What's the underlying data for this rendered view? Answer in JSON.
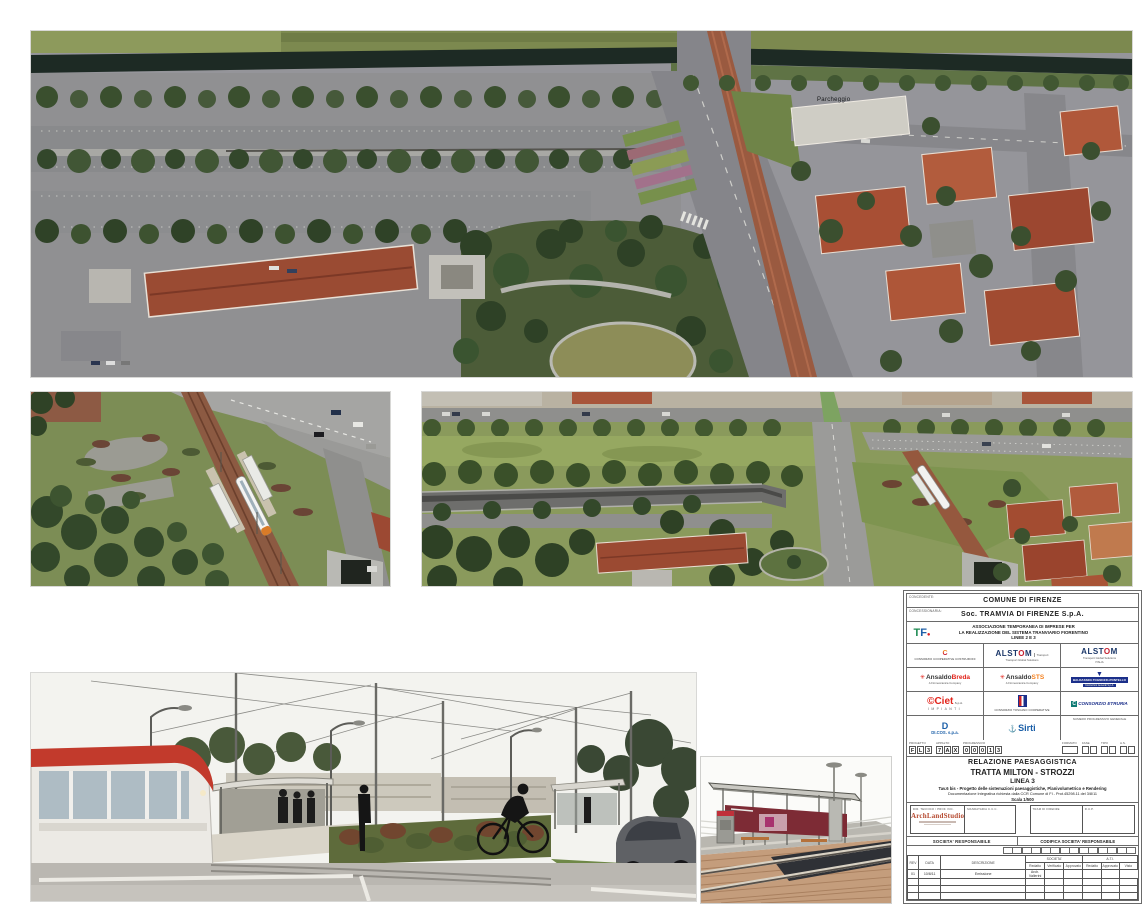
{
  "images": {
    "top_aerial": {
      "label_parcheggio": "Parcheggio"
    }
  },
  "title_block": {
    "concedente_label": "CONCEDENTE:",
    "concedente": "COMUNE DI FIRENZE",
    "concessionaria_label": "CONCESSIONARIA:",
    "concessionaria": "Soc. TRAMVIA DI FIRENZE S.p.A.",
    "tf_t": "T",
    "tf_f": "F",
    "tf_dot": "●",
    "ati_line1": "ASSOCIAZIONE TEMPORANEA DI IMPRESE PER",
    "ati_line2": "LA REALIZZAZIONE DEL SISTEMA TRANVIARIO FIORENTINO",
    "ati_line3": "LINEE 2 E 3",
    "logos": {
      "ccc_icon": "C",
      "ccc_caption": "CONSORZIO COOPERATIVE COSTRUZIONI",
      "alstom1_a": "ALST",
      "alstom1_o": "O",
      "alstom1_m": "M",
      "alstom1_tag": "Transport",
      "alstom1_sub": "Transport Global Solutions",
      "alstom2_a": "ALST",
      "alstom2_o": "O",
      "alstom2_m": "M",
      "alstom2_sub1": "Transport Global Solutions",
      "alstom2_sub2": "ITALIA",
      "sun": "✳",
      "ansaldobreda_1": "Ansaldo",
      "ansaldobreda_2": "Breda",
      "finmeccanica": "A Finmeccanica Company",
      "ansaldosts_1": "Ansaldo",
      "ansaldosts_2": "STS",
      "btp_glyph": "▼",
      "btp_name": "BALDASSINI-TOGNOZZI-PONTELLO",
      "btp_sub": "Costruzioni Generali S.p.A.",
      "ciet_name": "©Ciet",
      "ciet_spa": "S.p.A.",
      "ciet_sub": "IMPIANTI",
      "ctc_caption": "CONSORZIO TOSCANO COOPERATIVE",
      "etruria_c": "C",
      "etruria_name": "CONSORZIO ETRURIA",
      "dicos_d": "D",
      "dicos_name": "DI.COS. s.p.a.",
      "sirti_glyph": "⚓",
      "sirti_name": "Sirti",
      "numero_label": "NUMERO PROGRESSIVO GENERALE"
    },
    "codes": {
      "progetto_label": "PROGETTO",
      "progetto": [
        "F",
        "L",
        "3"
      ],
      "appalto_label": "APPALTO",
      "appalto": [
        "7",
        "A",
        "X"
      ],
      "progressivo_label": "PROGRESSIVO",
      "progressivo": [
        "0",
        "0",
        "0",
        "1",
        "3"
      ],
      "formato_label": "FORMATO",
      "fase_label": "FASE",
      "tipo_label": "TIPO",
      "as_label": "A.S."
    },
    "title": {
      "doc_type": "RELAZIONE PAESAGGISTICA",
      "tratta": "TRATTA MILTON - STROZZI",
      "linea": "LINEA 3",
      "tav": "Tav.6 bis - Progetto delle sistemazioni paesaggistiche, Planivolumetrico e Rendering",
      "doc_integrativa": "Documentazione Integrativa richiesta dalla CCR Comune di FI - Prot.45298.11 del 3/8/11",
      "scala": "Scala 1/500"
    },
    "signatures": {
      "dir_tecnico_label": "DIR. TECNICO / PROF. INC.",
      "archland_logo": "ArchLandStudio",
      "mandataria_label": "MANDATARIA C.C.C.",
      "tram_label": "TRAM DI FIRENZE",
      "rup_label": "R.U.P."
    },
    "societa": {
      "responsabile_label": "SOCIETA' RESPONSABILE",
      "codifica_label": "CODIFICA SOCIETA' RESPONSABILE"
    },
    "revisions": {
      "h_rev": "REV",
      "h_data": "DATA",
      "h_desc": "DESCRIZIONE",
      "h_societa": "SOCIETA'",
      "h_ati": "A.T.I.",
      "sub": [
        "Redatto",
        "Verificato",
        "Approvato",
        "Redatto",
        "Approvato",
        "Visto"
      ],
      "row1": {
        "rev": "01",
        "data": "10/8/11",
        "descrizione": "Emissione",
        "redatto": "Arch. Vallerini"
      }
    }
  }
}
